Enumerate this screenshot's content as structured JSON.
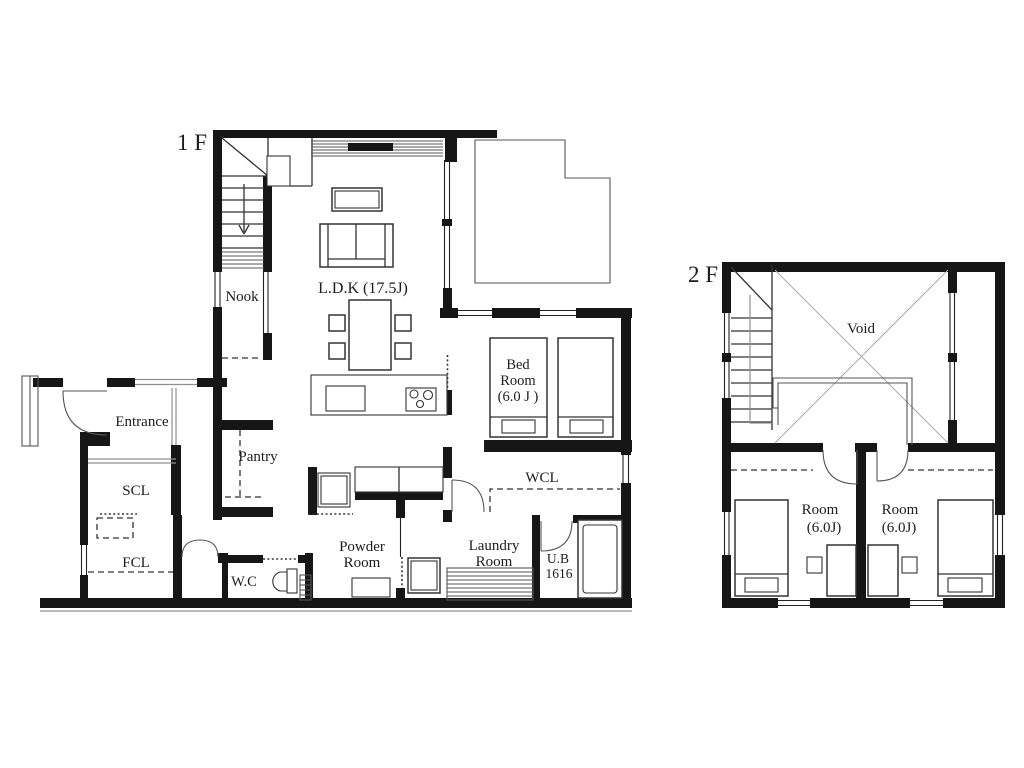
{
  "floor1": {
    "label": "1 F",
    "rooms": {
      "nook": "Nook",
      "ldk": "L.D.K   (17.5J)",
      "entrance": "Entrance",
      "scl": "SCL",
      "fcl": "FCL",
      "wc": "W.C",
      "pantry": "Pantry",
      "powder_line1": "Powder",
      "powder_line2": "Room",
      "laundry_line1": "Laundry",
      "laundry_line2": "Room",
      "ub_line1": "U.B",
      "ub_line2": "1616",
      "wcl": "WCL",
      "bedroom_line1": "Bed",
      "bedroom_line2": "Room",
      "bedroom_line3": "(6.0 J )"
    }
  },
  "floor2": {
    "label": "2 F",
    "rooms": {
      "void": "Void",
      "room_left_line1": "Room",
      "room_left_line2": "(6.0J)",
      "room_right_line1": "Room",
      "room_right_line2": "(6.0J)"
    }
  },
  "colors": {
    "wall": "#161616",
    "thin_line": "#333333",
    "gray_line": "#8f8f8f",
    "background": "#ffffff",
    "text": "#1c1c1c"
  }
}
